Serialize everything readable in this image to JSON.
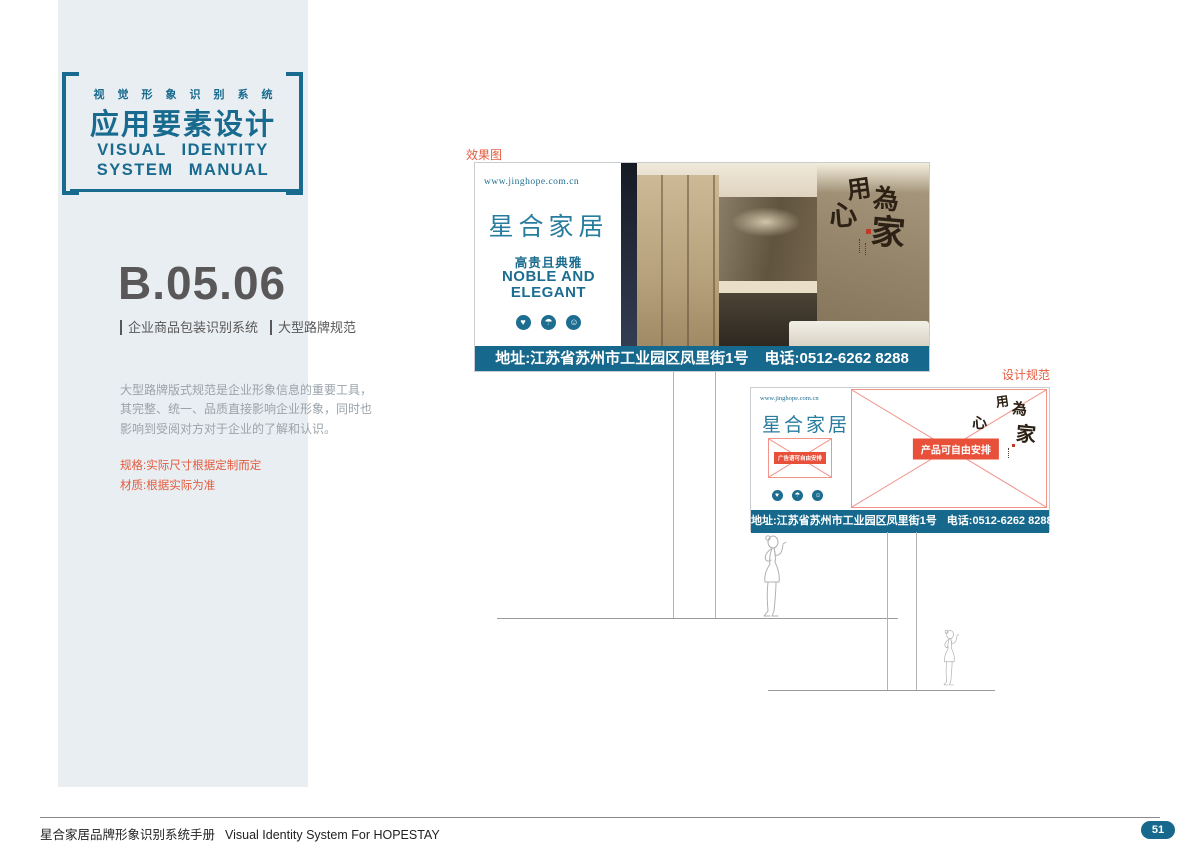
{
  "colors": {
    "brand_teal": "#16688c",
    "logo_teal": "#287c9e",
    "header_teal": "#186a8e",
    "accent_red": "#e45b3e",
    "placeholder_red": "#e8503a",
    "sidebar_bg": "#e9eef2"
  },
  "sidebar": {
    "header": {
      "tagline": "视觉形象识别系统",
      "title_cn": "应用要素设计",
      "title_en_line1": "VISUAL IDENTITY",
      "title_en_line2": "SYSTEM MANUAL"
    },
    "section_code": "B.05.06",
    "subtitle_left": "企业商品包装识别系统",
    "subtitle_right": "大型路牌规范",
    "description": "大型路牌版式规范是企业形象信息的重要工具，其完整、统一、品质直接影响企业形象，同时也影响到受阅对方对于企业的了解和认识。",
    "spec_line1": "规格:实际尺寸根据定制而定",
    "spec_line2": "材质:根据实际为准"
  },
  "brand": {
    "website": "www.jinghope.com.cn",
    "logo": "星合家居",
    "slogan_cn": "高贵且典雅",
    "slogan_en_line1": "NOBLE AND",
    "slogan_en_line2": "ELEGANT",
    "address": "地址:江苏省苏州市工业园区凤里街1号",
    "phone": "电话:0512-6262 8288",
    "calligraphy": {
      "c1": "用",
      "c2": "心",
      "c3": "為",
      "c4": "家"
    },
    "social_icons": [
      {
        "name": "heart",
        "glyph": "♥"
      },
      {
        "name": "umbrella",
        "glyph": "☂"
      },
      {
        "name": "smiley",
        "glyph": "☺"
      }
    ]
  },
  "effect_section": {
    "label": "效果图"
  },
  "spec_section": {
    "label": "设计规范",
    "placeholder_small": "广告语可自由安排",
    "placeholder_large": "产品可自由安排"
  },
  "footer": {
    "manual_title_cn": "星合家居品牌形象识别系统手册",
    "manual_title_en": "Visual Identity System For HOPESTAY",
    "page_number": "51"
  }
}
